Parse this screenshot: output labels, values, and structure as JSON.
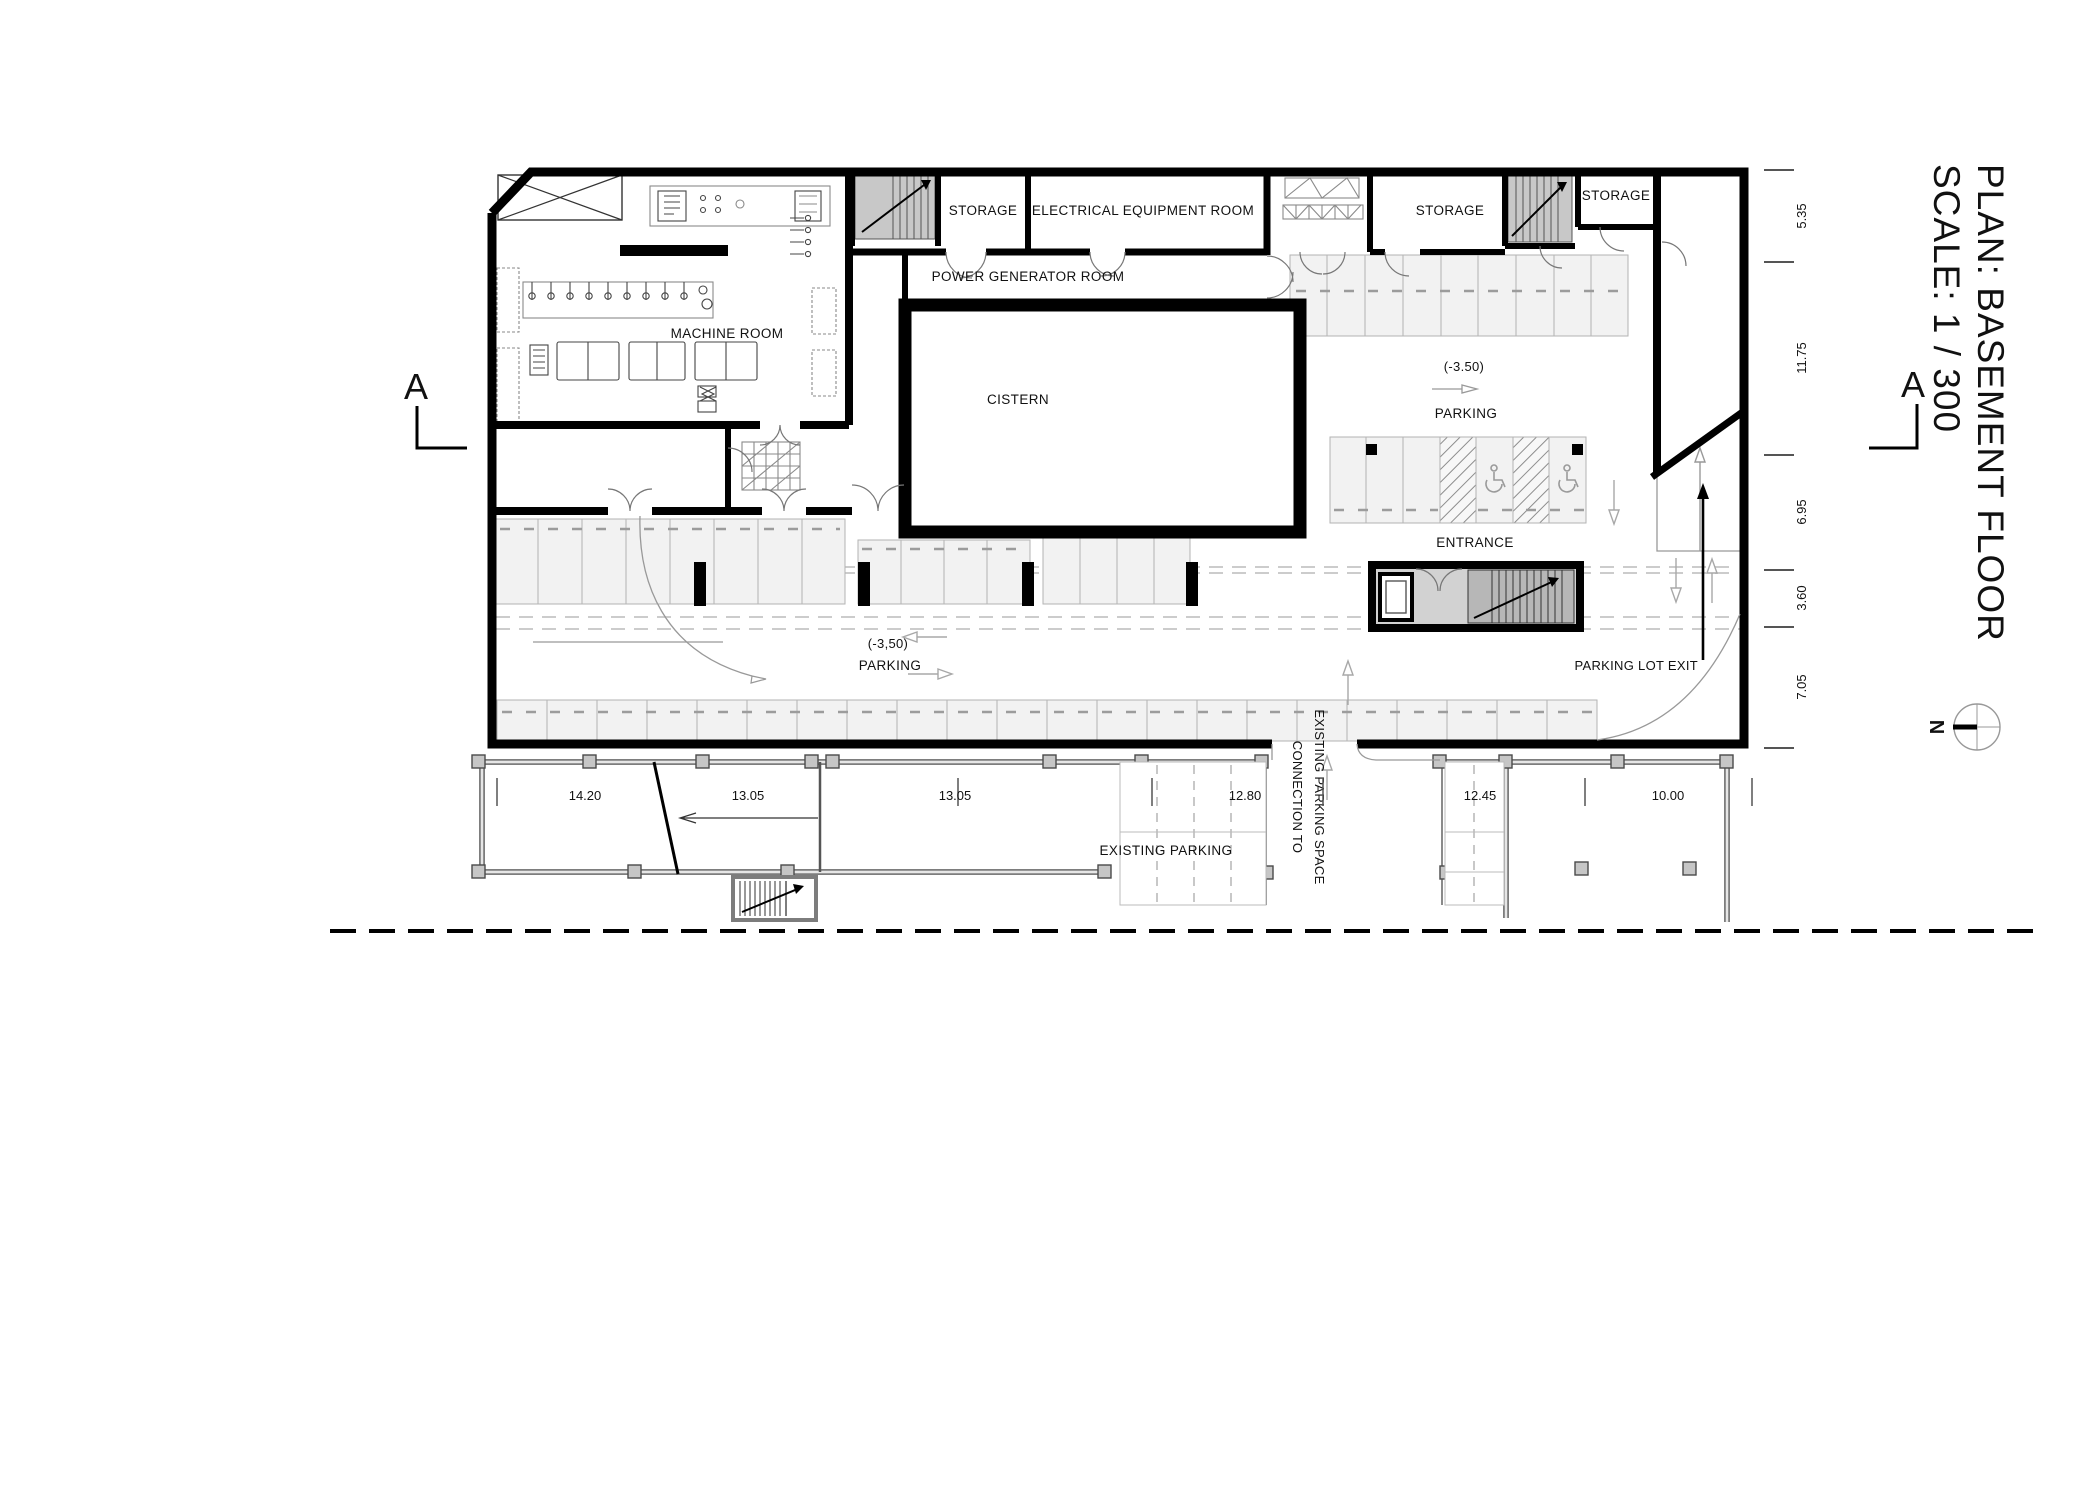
{
  "title": {
    "line1": "PLAN: BASEMENT FLOOR",
    "line2": "SCALE: 1 / 300"
  },
  "section_markers": {
    "left": "A",
    "right": "A"
  },
  "north": {
    "label": "N"
  },
  "rooms": {
    "machine_room": "MACHINE ROOM",
    "storage_1": "STORAGE",
    "electrical_equipment_room": "ELECTRICAL EQUIPMENT ROOM",
    "power_generator_room": "POWER GENERATOR ROOM",
    "cistern": "CISTERN",
    "storage_2": "STORAGE",
    "storage_3": "STORAGE"
  },
  "parking": {
    "level_right": "(-3.50)",
    "parking_right": "PARKING",
    "entrance": "ENTRANCE",
    "parking_lot_exit": "PARKING LOT EXIT",
    "level_left": "(-3,50)",
    "parking_left": "PARKING",
    "existing_parking": "EXISTING PARKING",
    "connection_line1": "CONNECTION TO",
    "connection_line2": "EXISTING PARKING SPACE"
  },
  "dimensions": {
    "right": [
      "5.35",
      "11.75",
      "6.95",
      "3.60",
      "7.05"
    ],
    "bottom": [
      "14.20",
      "13.05",
      "13.05",
      "12.80",
      "12.45",
      "10.00"
    ]
  }
}
